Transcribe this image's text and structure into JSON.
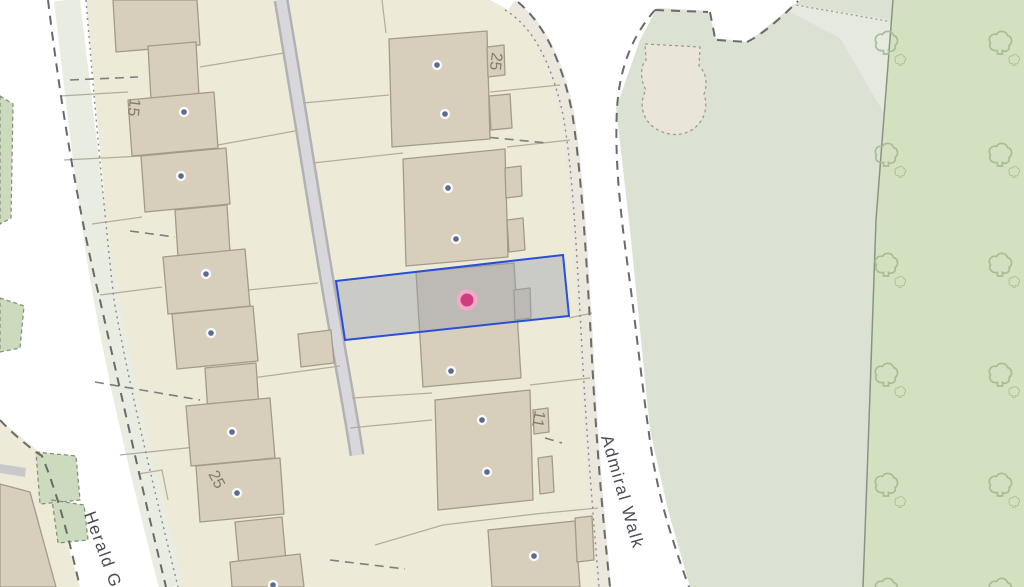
{
  "map": {
    "type": "cadastral-property-map",
    "streets": {
      "admiral_walk": "Admiral Walk",
      "herald": "Herald G"
    },
    "house_numbers": {
      "n25_top": "25",
      "n15": "15",
      "n11": "11",
      "n25_left": "25"
    },
    "selection": {
      "description": "selected parcel outline with building",
      "stroke": "#2a4fd7",
      "fill": "rgba(150,158,175,0.40)"
    },
    "marker": {
      "description": "selected property pin",
      "fill": "#ce3d7f",
      "ring": "#f2abc8"
    },
    "icons": [
      "location-marker-icon",
      "address-point-icon",
      "tree-icon"
    ],
    "colors": {
      "road": "#ffffff",
      "parcel": "#edead7",
      "verge": "#e9ece0",
      "building": "#d7cebb",
      "building_border": "#a39b86",
      "greenspace": "#dbe2d3",
      "woodland": "#d3e1c0",
      "access_road": "#d8d8dc",
      "address_dot": "#5b6b8d",
      "parcel_line": "#b4ac97",
      "boundary_dash": "#6a6a6a"
    }
  }
}
